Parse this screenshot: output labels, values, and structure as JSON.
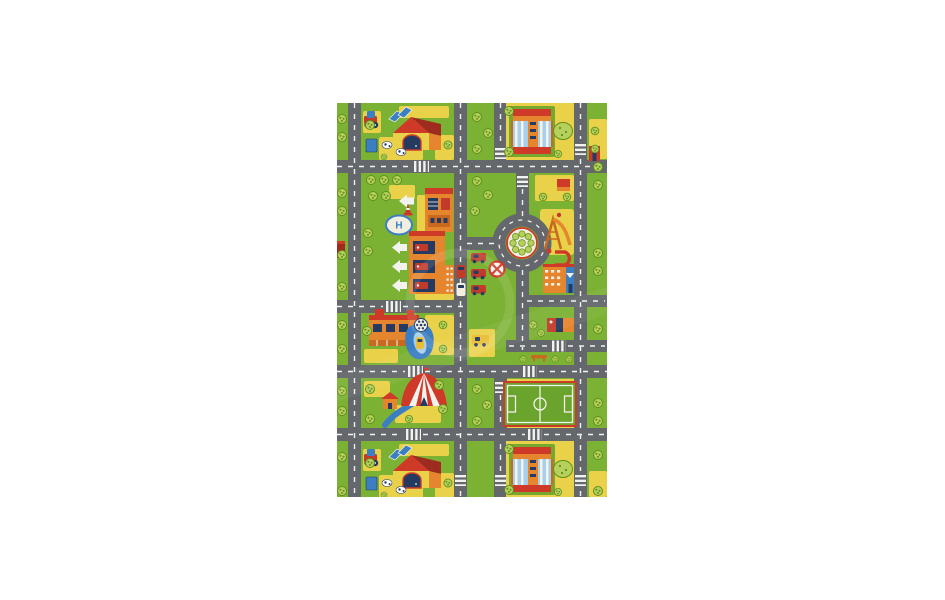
{
  "page": {
    "background_color": "#ffffff"
  },
  "product_image": {
    "subject": "children's play rug with city street map pattern on white background",
    "rug": {
      "x": 337,
      "y": 103,
      "width": 270,
      "height": 394,
      "labels": {
        "helipad": "H"
      },
      "palette": {
        "page": "#ffffff",
        "base": "#7cb233",
        "basepad": "#74a82e",
        "sand": "#e9d149",
        "road": "#64686d",
        "marking": "#f2f2ee",
        "tree": "#b6d05b",
        "treedark": "#5f8f1f",
        "roof": "#cf3a28",
        "darkred": "#9e2b1e",
        "orange": "#e5862f",
        "orangedark": "#c9691f",
        "navy": "#243a61",
        "blue": "#3b7fc2",
        "lightblue": "#a8cfe8",
        "island": "#f2efe0",
        "carred": "#c23b2a",
        "fieldgreen": "#6aa42d",
        "yellowcar": "#e9bd33",
        "white": "#ffffff"
      },
      "landmarks": [
        "farm house with red roof, barn door, tractor and cows (top-left)",
        "school building with striped facade and oval tree (top-right)",
        "red kiosk at right edge",
        "helipad with letter H",
        "hospital building",
        "garage with three vehicle bays and white exit arrows",
        "traffic cone",
        "roundabout with flower island",
        "playground with slide",
        "shops building with loop driveway",
        "cargo container",
        "park bench",
        "no-entry sign",
        "parked red cars",
        "car wash building with blue water slide and wheel",
        "yellow parked car",
        "circus tent with red and white stripes",
        "blue stream path and small cottage",
        "soccer field",
        "farm house repeat (bottom-left)",
        "school building repeat (bottom-right)",
        "trees and bushes",
        "gray roads with white dashes and crosswalks"
      ]
    },
    "watermark_present": true
  }
}
